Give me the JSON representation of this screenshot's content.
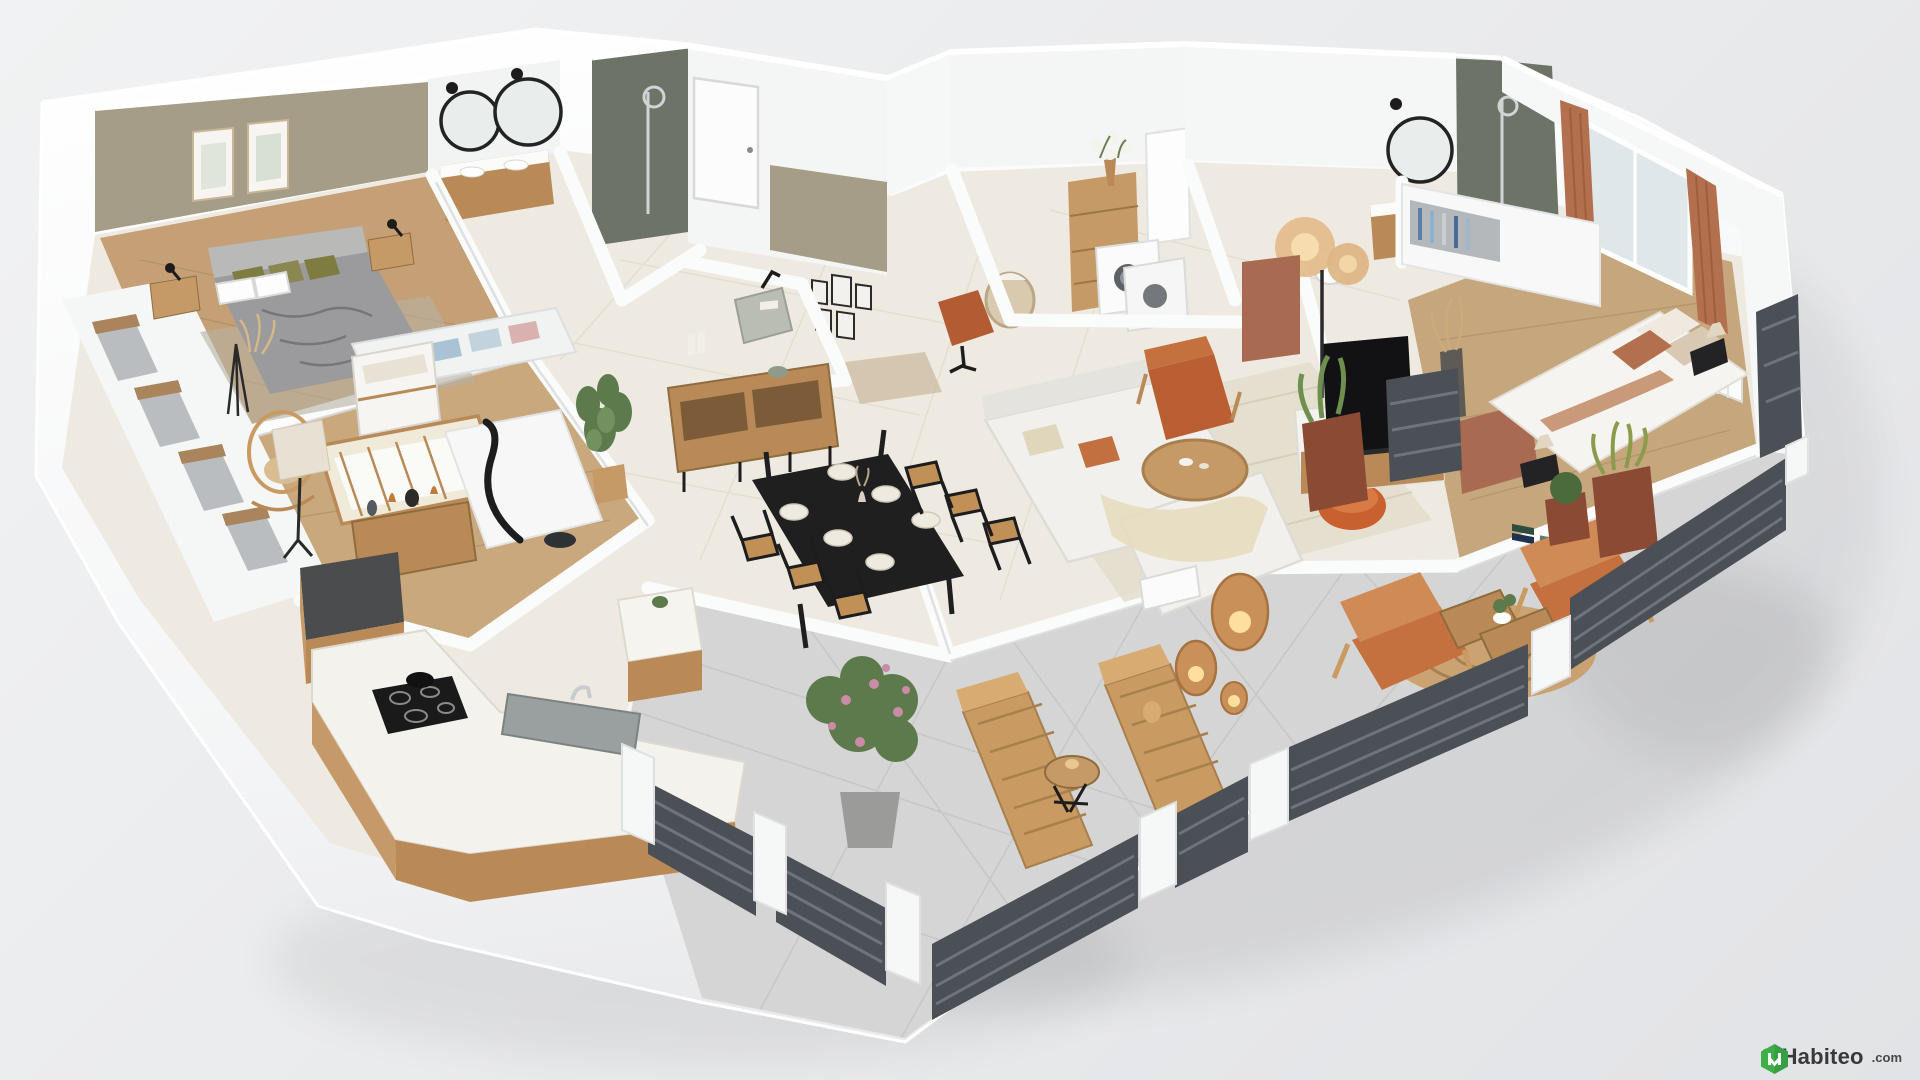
{
  "watermark": {
    "copyright": "©",
    "brand": "Habiteo",
    "tld": ".com"
  },
  "palette": {
    "background": "#e9eaec",
    "wall_white": "#f7f8f8",
    "wall_shade": "#e3e4e7",
    "floor_tile": "#eeeae1",
    "floor_wood": "#c5a077",
    "terrace_tile": "#d4d5d4",
    "accent_taupe": "#a59d87",
    "accent_terracotta": "#a96a52",
    "terracotta_fabric": "#b95f33",
    "curtain_rust": "#b3704e",
    "shower_tile": "#6e7368",
    "railing_gray": "#4a5056",
    "wood_furniture": "#b98a57",
    "rattan": "#c99a62",
    "olive_pillow": "#7f7c42",
    "sofa_white": "#f1f0ec",
    "black": "#1d1d1f",
    "logo_green": "#3fae49",
    "watermark_text": "#39393b"
  }
}
